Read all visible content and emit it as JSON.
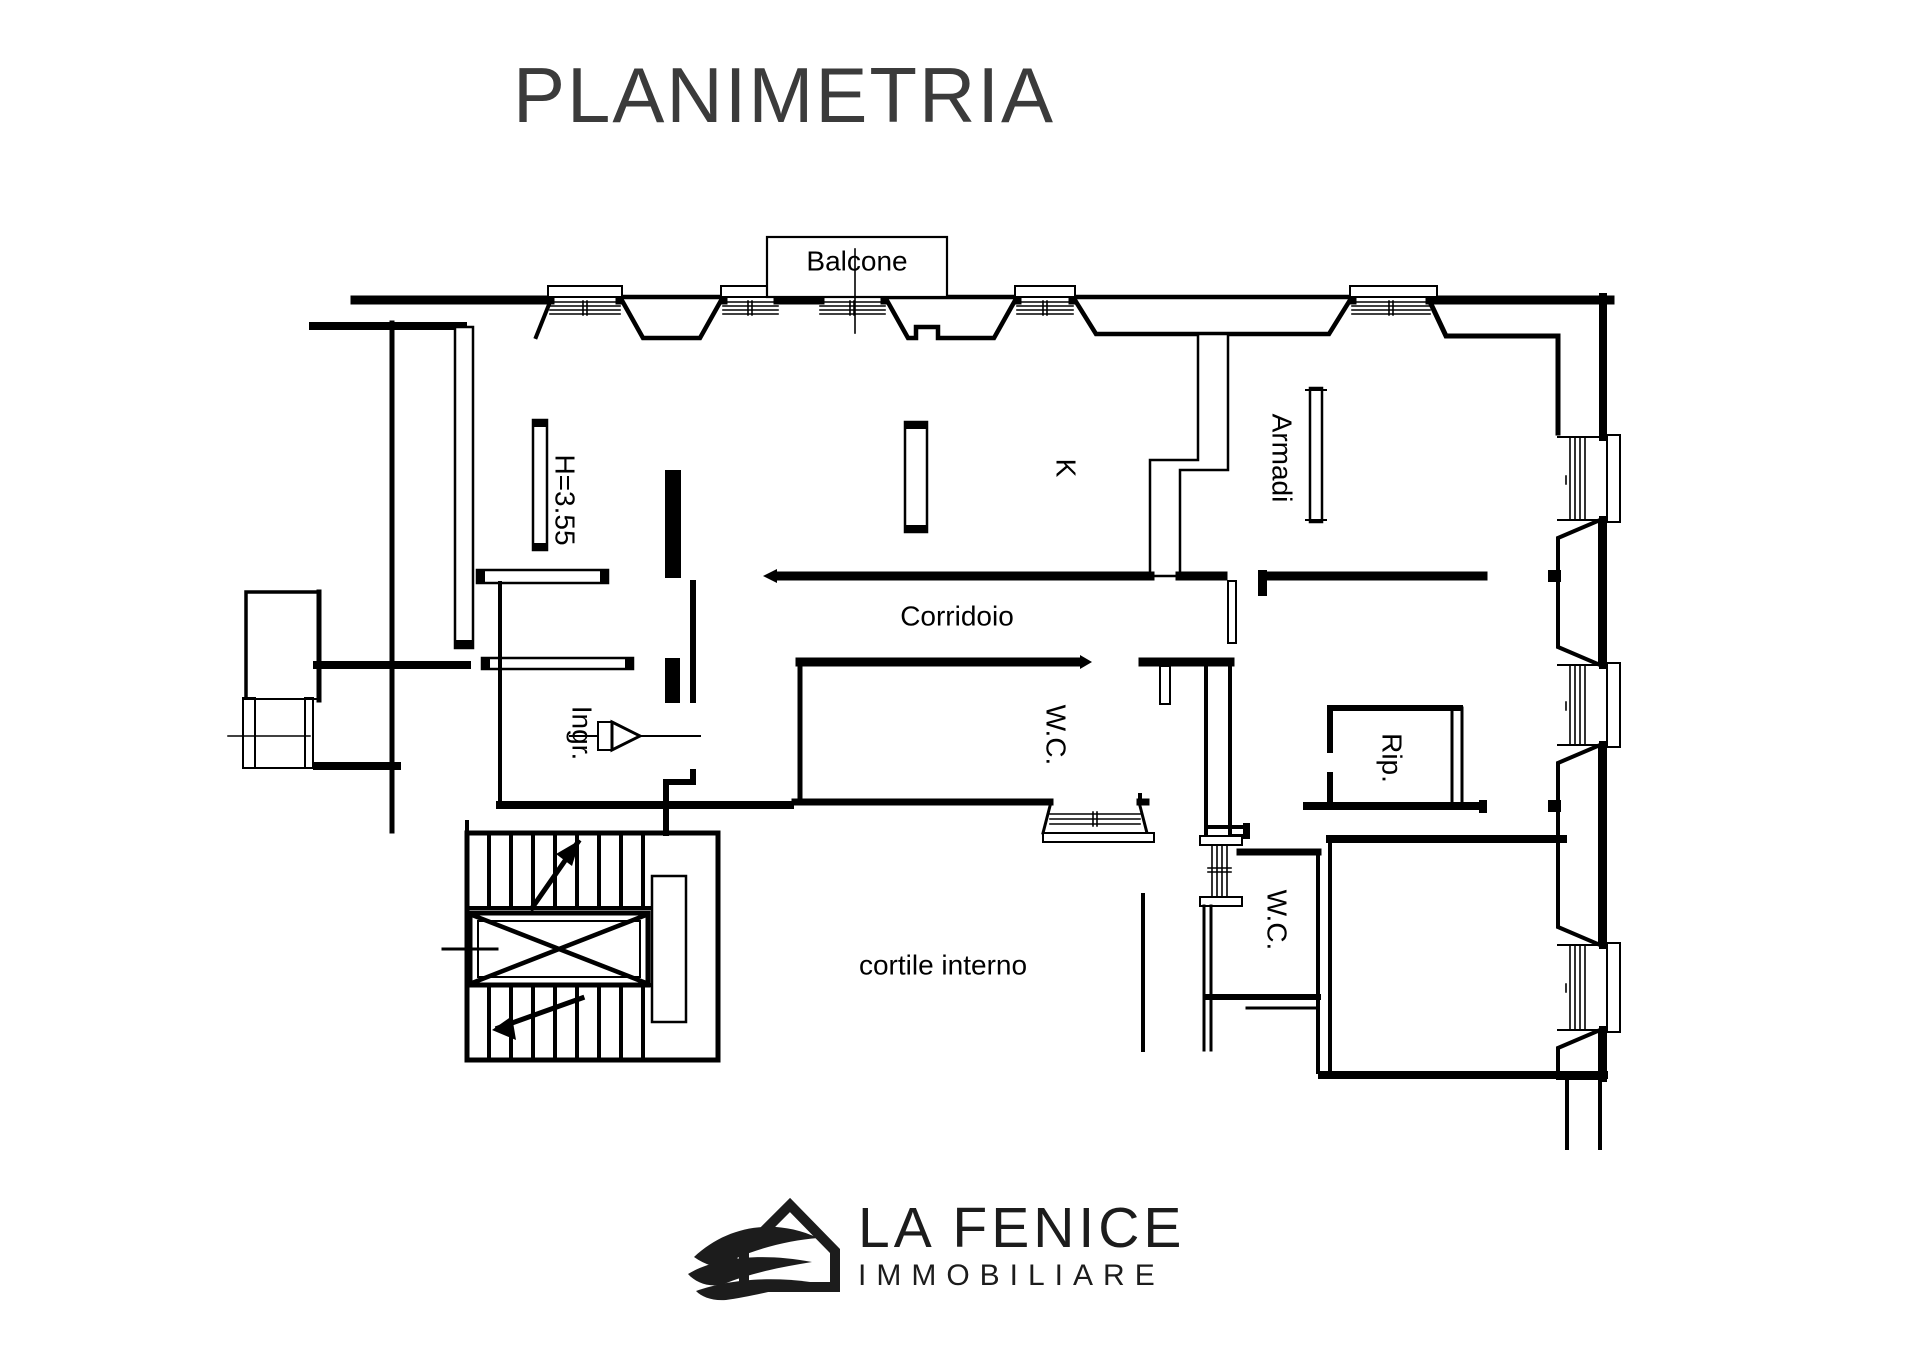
{
  "title": "PLANIMETRIA",
  "plan": {
    "labels": {
      "balcone": "Balcone",
      "height": "H=3.55",
      "kitchen": "K",
      "armadi": "Armadi",
      "corridoio": "Corridoio",
      "ingresso": "Ingr.",
      "wc_top": "W.C.",
      "rip": "Rip.",
      "wc_bottom": "W.C.",
      "cortile": "cortile interno"
    }
  },
  "logo": {
    "name": "LA FENICE",
    "subtitle": "IMMOBILIARE"
  },
  "colors": {
    "ink": "#000000",
    "title_text": "#3b3b3b",
    "logo_ink": "#1c1c1c",
    "background": "#ffffff"
  }
}
